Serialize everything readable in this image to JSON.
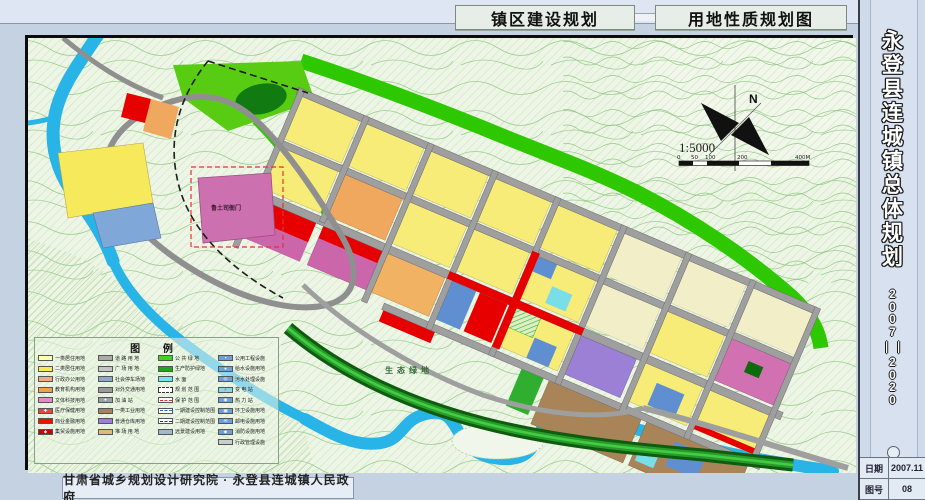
{
  "header": {
    "title_left": "镇区建设规划",
    "title_right": "用地性质规划图"
  },
  "titleblock": {
    "title": "永登县连城镇总体规划",
    "years": "2007——2020",
    "date_label": "日期",
    "date_value": "2007.11",
    "sheet_label": "图号",
    "sheet_value": "08"
  },
  "footer": {
    "credit": "甘肃省城乡规划设计研究院 · 永登县连城镇人民政府"
  },
  "map": {
    "landmark_label": "鲁土司衙门",
    "eco_label": "生态绿地",
    "compass_label": "N",
    "scale_text": "1:5000",
    "scale_ticks": [
      "0",
      "50",
      "100",
      "200",
      "400M"
    ]
  },
  "legend": {
    "title": "图  例",
    "columns": [
      [
        {
          "label": "一类居住用地",
          "bg": "#ffffb3"
        },
        {
          "label": "二类居住用地",
          "bg": "#f6e95c"
        },
        {
          "label": "行政办公用地",
          "bg": "#f2a97e"
        },
        {
          "label": "教育机构用地",
          "bg": "#f0a14c"
        },
        {
          "label": "文体科技用地",
          "bg": "#e989cb"
        },
        {
          "label": "医疗保健用地",
          "bg": "#e8463c",
          "sym": "✚"
        },
        {
          "label": "商业金融用地",
          "bg": "#ee1100"
        },
        {
          "label": "集贸设施用地",
          "bg": "#c40000",
          "sym": "◆"
        }
      ],
      [
        {
          "label": "道 路 用 地",
          "bg": "#ababab"
        },
        {
          "label": "广 场 用 地",
          "bg": "#c4c4c4"
        },
        {
          "label": "社会停车场地",
          "bg": "#88aacb"
        },
        {
          "label": "对外交通用地",
          "bg": "#9a9a9a"
        },
        {
          "label": "加 油 站",
          "bg": "#98a2aa",
          "sym": "●"
        },
        {
          "label": "一类工业用地",
          "bg": "#aa8459"
        },
        {
          "label": "普通仓库用地",
          "bg": "#9b80d5"
        },
        {
          "label": "堆 场 用 地",
          "bg": "#dcbc7e"
        }
      ],
      [
        {
          "label": "公 共 绿 地",
          "bg": "#3ed51e"
        },
        {
          "label": "生产防护绿地",
          "bg": "#1fa51f"
        },
        {
          "label": "水    面",
          "bg": "#7ae1f0"
        },
        {
          "label": "规 划 范 围",
          "bg": "#ffffff",
          "dash": true
        },
        {
          "label": "保 护 范 围",
          "bg": "#ffffff",
          "line": "#e83030"
        },
        {
          "label": "一期建设控制范围",
          "bg": "#ffffff",
          "line": "#3a5fc8"
        },
        {
          "label": "二期建设控制范围",
          "bg": "#ffffff",
          "line": "#233a66"
        },
        {
          "label": "远景建设用地",
          "bg": "#a3b8cd"
        }
      ],
      [
        {
          "label": "公用工程设施",
          "bg": "#6f9ed9",
          "sym": "▪"
        },
        {
          "label": "给水设施用地",
          "bg": "#6f9ed9",
          "sym": "●"
        },
        {
          "label": "污水处理设施",
          "bg": "#6f9ed9",
          "sym": "◎"
        },
        {
          "label": "变 电 站",
          "bg": "#86d8ea",
          "sym": "⚡",
          "symc": "#d22"
        },
        {
          "label": "热 力 站",
          "bg": "#6f9ed9",
          "sym": "◉"
        },
        {
          "label": "环卫设施用地",
          "bg": "#6f9ed9",
          "sym": "▣"
        },
        {
          "label": "邮电设施用地",
          "bg": "#6f9ed9",
          "sym": "✉"
        },
        {
          "label": "消防设施用地",
          "bg": "#6f9ed9",
          "sym": "◆"
        },
        {
          "label": "行政管理设施",
          "bg": "#c9cdd2",
          "sym": ""
        }
      ]
    ]
  },
  "colors": {
    "frame_bg": "#c5d2e2",
    "map_bg": "#edf5e6",
    "river": "#29b4e8",
    "road": "#9f9f9f",
    "green_belt": "#2ec800",
    "bank_green": "#0e5c10",
    "residential": "#f6ec77",
    "commercial": "#e60000",
    "culture_pink": "#cc66aa",
    "industry_brown": "#aa8459",
    "warehouse_purple": "#9b80d5",
    "facility_blue": "#5f8fd0"
  }
}
